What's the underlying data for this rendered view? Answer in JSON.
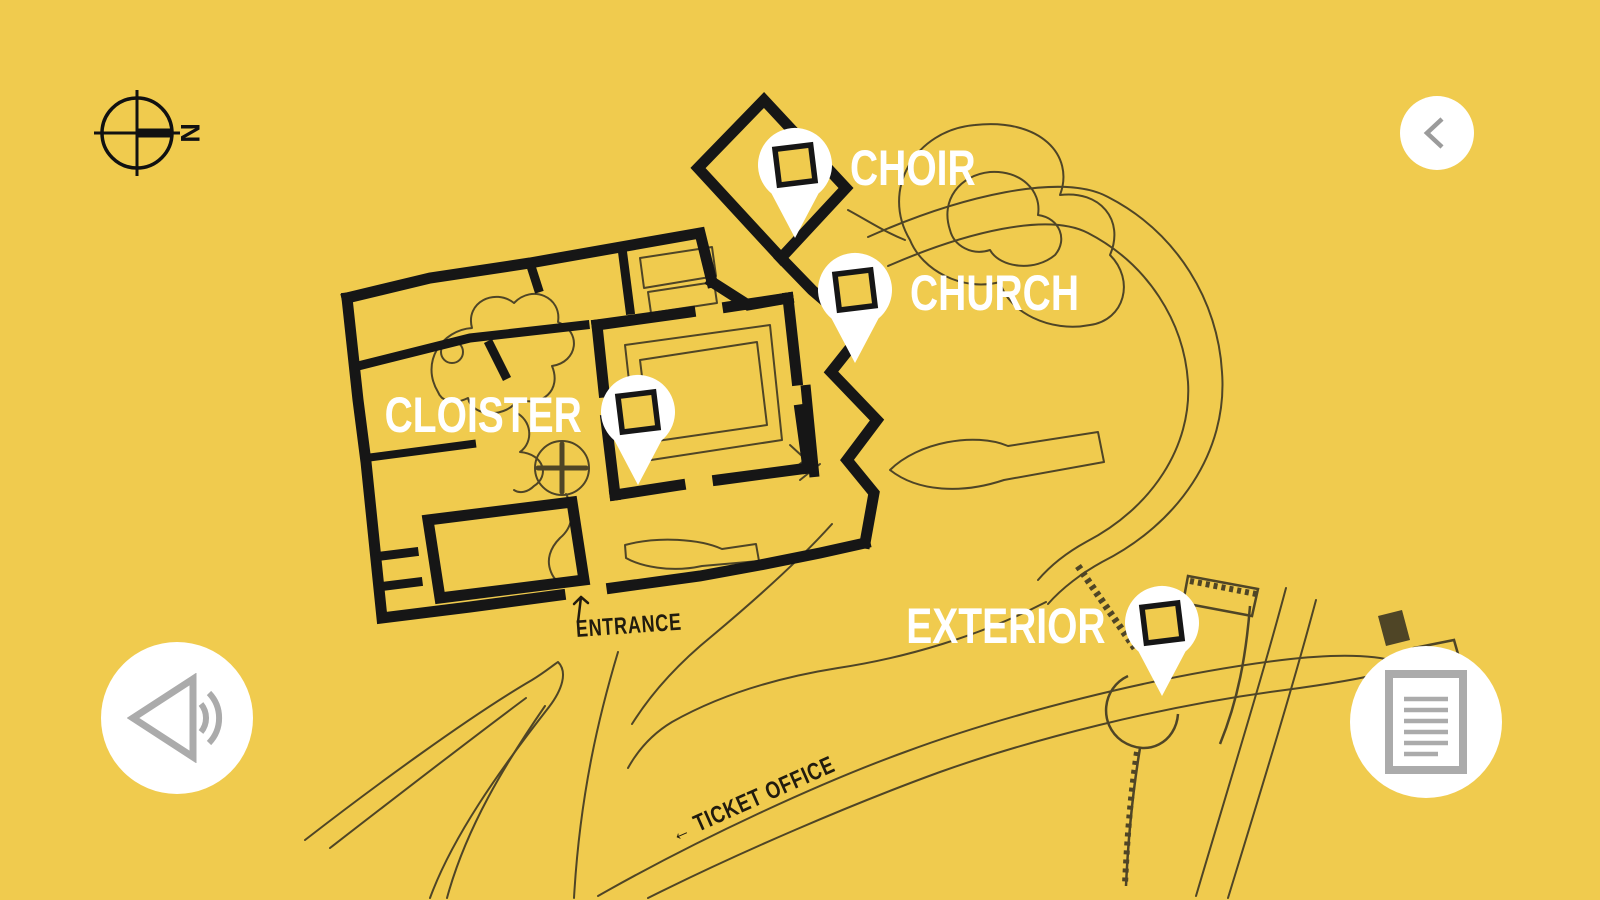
{
  "screen": {
    "background_color": "#F0CB4E",
    "wall_color": "#161616",
    "map_line_color": "#4F4526",
    "pin_color": "#FFFFFF",
    "button_icon_color": "#ABABAB"
  },
  "compass": {
    "north_label": "N"
  },
  "pins": [
    {
      "id": "choir",
      "label": "CHOIR",
      "label_side": "right"
    },
    {
      "id": "church",
      "label": "CHURCH",
      "label_side": "right"
    },
    {
      "id": "cloister",
      "label": "CLOISTER",
      "label_side": "left"
    },
    {
      "id": "exterior",
      "label": "EXTERIOR",
      "label_side": "left"
    }
  ],
  "map_labels": {
    "entrance": "ENTRANCE",
    "ticket_office": "← TICKET OFFICE"
  },
  "buttons": {
    "back": {
      "icon": "chevron-left-icon"
    },
    "audio": {
      "icon": "speaker-icon"
    },
    "notes": {
      "icon": "document-icon"
    }
  }
}
